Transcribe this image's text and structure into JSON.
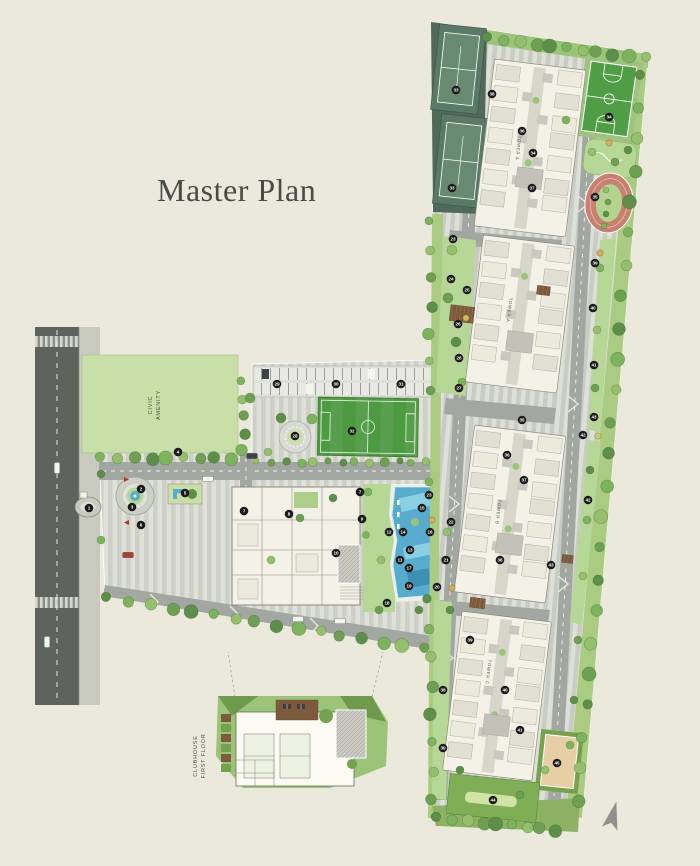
{
  "title": "Master Plan",
  "labels": {
    "civic_line1": "CIVIC",
    "civic_line2": "AMENITY",
    "tower_a": "TOWER A",
    "tower_a2": "TOWER A",
    "tower_b": "TOWER B",
    "tower_c": "TOWER C",
    "club_line1": "CLUBHOUSE",
    "club_line2": "FIRST FLOOR"
  },
  "colors": {
    "background": "#ebe9dc",
    "title_text": "#474c44",
    "road": "#a2a8a1",
    "road_dark": "#5f635e",
    "paving": "#dfe1d8",
    "lawn": "#b7d797",
    "civic_green": "#c9dfa8",
    "field_green": "#4d9a41",
    "tennis_green": "#5b7a65",
    "basketball_green": "#4f9e45",
    "track_red": "#c8806f",
    "pool_blue": "#57acce",
    "building": "#f4f2e6",
    "marker": "#1a1a1a",
    "marker_text": "#ffffff",
    "tree_dark": "#5e8f4a",
    "tree_mid": "#7cb35c",
    "tree_light": "#94c06e",
    "deck_brown": "#7d5a3c",
    "sand": "#e6cfa4",
    "compass": "#8f928c"
  },
  "markers": [
    {
      "n": 1,
      "x": 89,
      "y": 508
    },
    {
      "n": 2,
      "x": 141,
      "y": 489
    },
    {
      "n": 3,
      "x": 132,
      "y": 507
    },
    {
      "n": 4,
      "x": 178,
      "y": 452
    },
    {
      "n": 5,
      "x": 185,
      "y": 493
    },
    {
      "n": 6,
      "x": 141,
      "y": 525
    },
    {
      "n": 7,
      "x": 244,
      "y": 511
    },
    {
      "n": 7,
      "x": 360,
      "y": 492
    },
    {
      "n": 8,
      "x": 289,
      "y": 514
    },
    {
      "n": 9,
      "x": 362,
      "y": 519
    },
    {
      "n": 10,
      "x": 336,
      "y": 553
    },
    {
      "n": 11,
      "x": 400,
      "y": 560
    },
    {
      "n": 12,
      "x": 389,
      "y": 532
    },
    {
      "n": 13,
      "x": 410,
      "y": 550
    },
    {
      "n": 14,
      "x": 403,
      "y": 532
    },
    {
      "n": 15,
      "x": 422,
      "y": 508
    },
    {
      "n": 16,
      "x": 430,
      "y": 532
    },
    {
      "n": 17,
      "x": 409,
      "y": 568
    },
    {
      "n": 18,
      "x": 387,
      "y": 603
    },
    {
      "n": 19,
      "x": 409,
      "y": 586
    },
    {
      "n": 20,
      "x": 437,
      "y": 587
    },
    {
      "n": 21,
      "x": 446,
      "y": 560
    },
    {
      "n": 22,
      "x": 451,
      "y": 522
    },
    {
      "n": 23,
      "x": 429,
      "y": 495
    },
    {
      "n": 23,
      "x": 453,
      "y": 239
    },
    {
      "n": 24,
      "x": 451,
      "y": 279
    },
    {
      "n": 25,
      "x": 467,
      "y": 290
    },
    {
      "n": 26,
      "x": 458,
      "y": 324
    },
    {
      "n": 26,
      "x": 459,
      "y": 358
    },
    {
      "n": 27,
      "x": 459,
      "y": 388
    },
    {
      "n": 28,
      "x": 295,
      "y": 436
    },
    {
      "n": 29,
      "x": 277,
      "y": 384
    },
    {
      "n": 30,
      "x": 336,
      "y": 384
    },
    {
      "n": 31,
      "x": 401,
      "y": 384
    },
    {
      "n": 32,
      "x": 352,
      "y": 431
    },
    {
      "n": 33,
      "x": 456,
      "y": 90
    },
    {
      "n": 33,
      "x": 452,
      "y": 188
    },
    {
      "n": 34,
      "x": 609,
      "y": 117
    },
    {
      "n": 34,
      "x": 533,
      "y": 153
    },
    {
      "n": 35,
      "x": 595,
      "y": 197
    },
    {
      "n": 35,
      "x": 522,
      "y": 420
    },
    {
      "n": 36,
      "x": 522,
      "y": 131
    },
    {
      "n": 36,
      "x": 507,
      "y": 455
    },
    {
      "n": 37,
      "x": 532,
      "y": 188
    },
    {
      "n": 37,
      "x": 524,
      "y": 480
    },
    {
      "n": 38,
      "x": 492,
      "y": 94
    },
    {
      "n": 38,
      "x": 500,
      "y": 560
    },
    {
      "n": 38,
      "x": 443,
      "y": 690
    },
    {
      "n": 39,
      "x": 595,
      "y": 263
    },
    {
      "n": 39,
      "x": 470,
      "y": 640
    },
    {
      "n": 39,
      "x": 443,
      "y": 748
    },
    {
      "n": 40,
      "x": 593,
      "y": 308
    },
    {
      "n": 40,
      "x": 505,
      "y": 690
    },
    {
      "n": 41,
      "x": 594,
      "y": 365
    },
    {
      "n": 41,
      "x": 520,
      "y": 730
    },
    {
      "n": 42,
      "x": 583,
      "y": 435
    },
    {
      "n": 42,
      "x": 588,
      "y": 500
    },
    {
      "n": 43,
      "x": 594,
      "y": 417
    },
    {
      "n": 43,
      "x": 551,
      "y": 565
    },
    {
      "n": 44,
      "x": 493,
      "y": 800
    },
    {
      "n": 45,
      "x": 557,
      "y": 763
    }
  ],
  "decor": {
    "tree_rows": [
      {
        "x1": 489,
        "y1": 38,
        "x2": 644,
        "y2": 58,
        "n": 11,
        "r": 6,
        "tone": 0
      },
      {
        "x1": 642,
        "y1": 76,
        "x2": 578,
        "y2": 800,
        "n": 24,
        "r": 6,
        "tone": 0
      },
      {
        "x1": 431,
        "y1": 222,
        "x2": 429,
        "y2": 390,
        "n": 7,
        "r": 5,
        "tone": 1
      },
      {
        "x1": 429,
        "y1": 600,
        "x2": 433,
        "y2": 800,
        "n": 8,
        "r": 5.5,
        "tone": 0
      },
      {
        "x1": 102,
        "y1": 458,
        "x2": 232,
        "y2": 458,
        "n": 9,
        "r": 6,
        "tone": 1
      },
      {
        "x1": 108,
        "y1": 598,
        "x2": 425,
        "y2": 649,
        "n": 16,
        "r": 6,
        "tone": 0
      },
      {
        "x1": 258,
        "y1": 462,
        "x2": 426,
        "y2": 462,
        "n": 13,
        "r": 4,
        "tone": 2
      },
      {
        "x1": 243,
        "y1": 382,
        "x2": 243,
        "y2": 450,
        "n": 5,
        "r": 5,
        "tone": 1
      },
      {
        "x1": 438,
        "y1": 818,
        "x2": 556,
        "y2": 830,
        "n": 9,
        "r": 6,
        "tone": 0
      }
    ],
    "trees": [
      [
        281,
        418,
        5
      ],
      [
        312,
        419,
        5
      ],
      [
        268,
        452,
        4
      ],
      [
        250,
        398,
        5
      ],
      [
        101,
        474,
        4
      ],
      [
        101,
        540,
        4
      ],
      [
        271,
        560,
        4
      ],
      [
        300,
        518,
        4
      ],
      [
        333,
        498,
        4
      ],
      [
        368,
        492,
        4
      ],
      [
        381,
        560,
        4
      ],
      [
        379,
        610,
        4
      ],
      [
        419,
        610,
        4
      ],
      [
        366,
        535,
        3.5
      ],
      [
        452,
        250,
        5
      ],
      [
        448,
        298,
        5
      ],
      [
        456,
        342,
        5
      ],
      [
        462,
        382,
        4
      ],
      [
        447,
        532,
        4
      ],
      [
        445,
        560,
        4
      ],
      [
        450,
        610,
        4
      ],
      [
        600,
        268,
        4
      ],
      [
        597,
        330,
        4
      ],
      [
        595,
        388,
        4
      ],
      [
        590,
        470,
        4
      ],
      [
        587,
        520,
        4
      ],
      [
        583,
        576,
        4
      ],
      [
        578,
        640,
        4
      ],
      [
        574,
        700,
        4
      ],
      [
        570,
        745,
        4
      ],
      [
        592,
        152,
        4
      ],
      [
        615,
        162,
        4
      ],
      [
        628,
        150,
        4
      ],
      [
        566,
        120,
        4
      ],
      [
        545,
        770,
        4
      ],
      [
        520,
        795,
        4
      ],
      [
        460,
        770,
        4
      ],
      [
        429,
        482,
        4
      ],
      [
        606,
        190,
        3
      ],
      [
        608,
        202,
        3
      ],
      [
        606,
        214,
        3
      ],
      [
        604,
        226,
        3
      ]
    ],
    "shrubs": [
      [
        609,
        143,
        "#d9a95e"
      ],
      [
        466,
        318,
        "#cdbb62"
      ],
      [
        600,
        253,
        "#d9a95e"
      ],
      [
        452,
        588,
        "#d9a95e"
      ],
      [
        598,
        436,
        "#cdc86e"
      ],
      [
        432,
        520,
        "#d9a95e"
      ]
    ],
    "cars": [
      [
        57,
        468,
        "v",
        "#f5f5f0"
      ],
      [
        47,
        642,
        "v",
        "#f5f5f0"
      ],
      [
        128,
        555,
        "h",
        "#b03a2e"
      ],
      [
        252,
        456,
        "h",
        "#3d4246"
      ],
      [
        298,
        619,
        "h",
        "#f5f5f0"
      ],
      [
        340,
        621,
        "h",
        "#f5f5f0"
      ],
      [
        208,
        479,
        "h",
        "#f5f5f0"
      ]
    ],
    "clusters": [
      {
        "name": "tower-a-upper-building",
        "x": 484,
        "y": 64,
        "w": 92,
        "h": 168,
        "rot": 7
      },
      {
        "name": "tower-a-lower-building",
        "x": 474,
        "y": 240,
        "w": 92,
        "h": 148,
        "rot": 7
      },
      {
        "name": "tower-b-building",
        "x": 464,
        "y": 430,
        "w": 92,
        "h": 168,
        "rot": 7
      },
      {
        "name": "tower-c-building",
        "x": 452,
        "y": 616,
        "w": 90,
        "h": 160,
        "rot": 7
      }
    ],
    "pergolas": [
      [
        450,
        306,
        24,
        16
      ],
      [
        537,
        286,
        13,
        9
      ],
      [
        470,
        598,
        15,
        10
      ],
      [
        562,
        555,
        11,
        8
      ]
    ]
  }
}
